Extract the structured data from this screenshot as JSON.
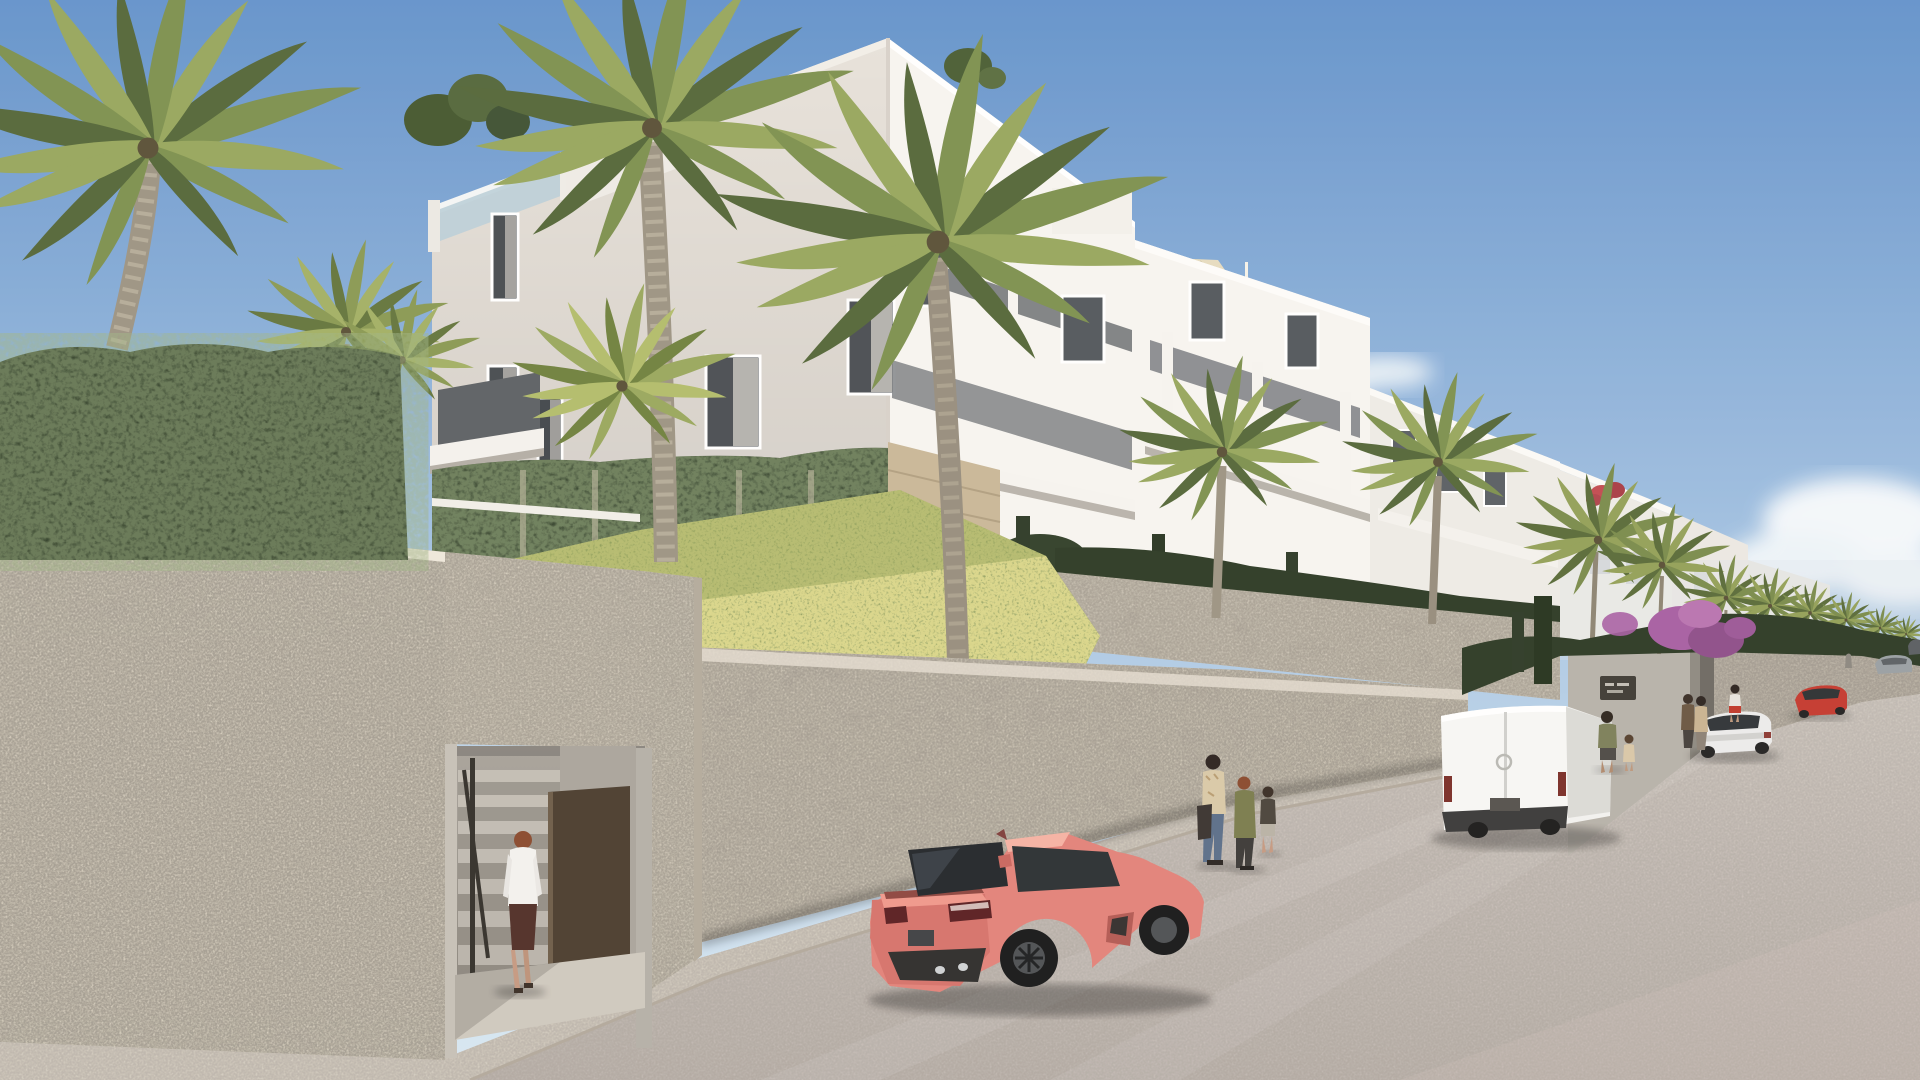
{
  "meta": {
    "title": "Architectural render — modern white apartment complex above a stone-walled street",
    "image_type": "3D exterior visualization",
    "time_of_day": "day",
    "weather": "clear sunny sky"
  },
  "palette": {
    "sky_top": "#6493cc",
    "sky_mid": "#9bbcdf",
    "sky_horizon": "#d9e8f3",
    "facade_sunlit": "#f7f5f1",
    "facade_shaded": "#e7e2db",
    "facade_distant": "#eeece6",
    "stone_wall": "#d6cfc1",
    "stone_wall_shaded": "#c7bfb2",
    "stone_accent": "#c9b898",
    "concrete": "#b7b2aa",
    "ivy_green": "#2f3d29",
    "hedge_green": "#2d3b26",
    "grass_green": "#6f8142",
    "flower_yellow": "#d8c94f",
    "bougainvillea_purple": "#a75fa3",
    "bougainvillea_red": "#c24b52",
    "palm_frond": "#7d9150",
    "palm_frond_dark": "#55683a",
    "palm_trunk": "#9d9484",
    "road": "#c6beb8",
    "sidewalk": "#d9d2c7",
    "shade_sail": "#e6dcc0",
    "door_brown": "#4b3e2f",
    "sign_plaque": "#3f3c36",
    "car_coral": "#e2837a",
    "car_coral_dark": "#b85e58",
    "van_white": "#f2f2f0",
    "sedan_white": "#ececec",
    "car_red": "#c43a2f",
    "car_gray": "#9aa0a4",
    "glass_dark": "#2b3034",
    "woman_blouse": "#f3f2ef",
    "woman_skirt": "#512f28",
    "red_woman_skirt": "#c0392b"
  },
  "scene": {
    "sky": {
      "label": "clear blue sky, soft white cloud lower right",
      "cloud_count": 2
    },
    "buildings": {
      "label": "white modern apartment blocks stepping down the hillside to the right",
      "blocks": [
        {
          "label": "main three-storey corner block with rooftop glass balustrade and curtained windows"
        },
        {
          "label": "second block with balcony band and beige roof shade sail"
        },
        {
          "label": "third receding block with small terraces"
        },
        {
          "label": "distant white villas with red bougainvillea on a roof terrace"
        }
      ],
      "features": [
        "glass balustrades",
        "sheer curtains",
        "ivy-clad base wall",
        "stacked-stone accent wall",
        "rooftop plants"
      ]
    },
    "vegetation": {
      "foreground_palms": 4,
      "midground_palms": 2,
      "distant_palm_row": 8,
      "hedges": "dark clipped hedges above the stone walls",
      "grass": "sunlit grass slope with small yellow flowers",
      "bougainvillea": "purple bougainvillea spilling over the upper wall; red bougainvillea on distant roof"
    },
    "walls": {
      "foreground": "tall rough-stone wall filling the lower left with recessed pedestrian entrance",
      "street_side": "stone retaining wall running up the street behind the parked cars",
      "upper_terrace": "second stone terrace wall topped with hedges below the buildings"
    },
    "entrance": {
      "label": "recessed entrance with concrete stairs, dark handrail and open dark-brown door",
      "door_state": "open"
    },
    "sign": {
      "label": "dark plaque beside upper street entrance",
      "text": "",
      "legible": false
    },
    "street": {
      "label": "smooth light-gray street climbing toward the upper right",
      "sidewalk": "sunlit sidewalk with curb along the stone wall"
    },
    "vehicles": [
      {
        "label": "coral-pink sports coupe parked at left, rear three-quarter view, dark alloy wheels"
      },
      {
        "label": "white panel van parked against the wall farther up"
      },
      {
        "label": "white sedan parked on the right, rear view"
      },
      {
        "label": "red compact car heading uphill on the right"
      },
      {
        "label": "silver car near the crest"
      },
      {
        "label": "small dark car at the crest"
      }
    ],
    "people": [
      {
        "label": "woman in white blouse and dark skirt walking toward the entrance stairs",
        "location": "foreground entrance"
      },
      {
        "label": "two women and a child walking past the wall",
        "count": 3,
        "location": "sidewalk center"
      },
      {
        "label": "man with small child near the white van",
        "count": 2
      },
      {
        "label": "two people standing at the upper street entrance",
        "count": 2
      },
      {
        "label": "woman in white top and red skirt on the far sidewalk",
        "count": 1
      },
      {
        "label": "distant pedestrian near the crest",
        "count": 1
      }
    ]
  }
}
